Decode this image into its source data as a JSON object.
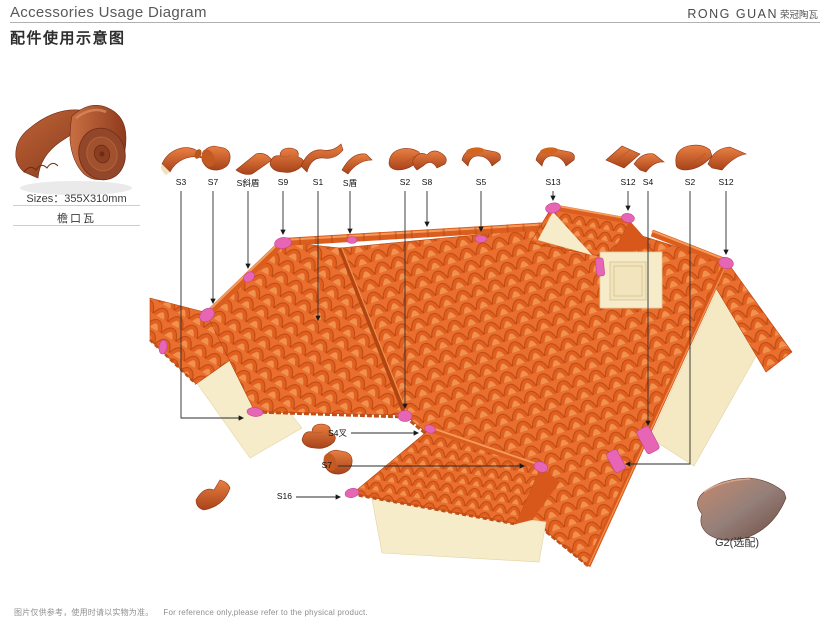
{
  "header": {
    "title_en": "Accessories Usage Diagram",
    "title_cn": "配件使用示意图",
    "brand_en": "RONG GUAN",
    "brand_cn": "荣冠陶瓦"
  },
  "product": {
    "sizes_label": "Sizes：355X310mm",
    "name_cn": "檐口瓦"
  },
  "diagram": {
    "top_labels": [
      {
        "id": "S3"
      },
      {
        "id": "S7"
      },
      {
        "id": "S斜盾"
      },
      {
        "id": "S9"
      },
      {
        "id": "S1"
      },
      {
        "id": "S盾"
      },
      {
        "id": "S2"
      },
      {
        "id": "S8"
      },
      {
        "id": "S5"
      },
      {
        "id": "S13"
      },
      {
        "id": "S12"
      },
      {
        "id": "S4"
      },
      {
        "id": "S2"
      },
      {
        "id": "S12"
      }
    ],
    "callout_labels": [
      {
        "id": "S4叉"
      },
      {
        "id": "S7"
      },
      {
        "id": "S16"
      }
    ],
    "optional_label": "G2(选配)"
  },
  "footer": {
    "note_cn": "图片仅供参考，使用时请以实物为准。",
    "note_en": "For reference only,please refer to the physical product."
  },
  "palette": {
    "tile_orange": "#E8702F",
    "tile_shadow": "#B9470F",
    "accent_pink": "#E765B5",
    "wall_cream": "#F6ECC9"
  }
}
